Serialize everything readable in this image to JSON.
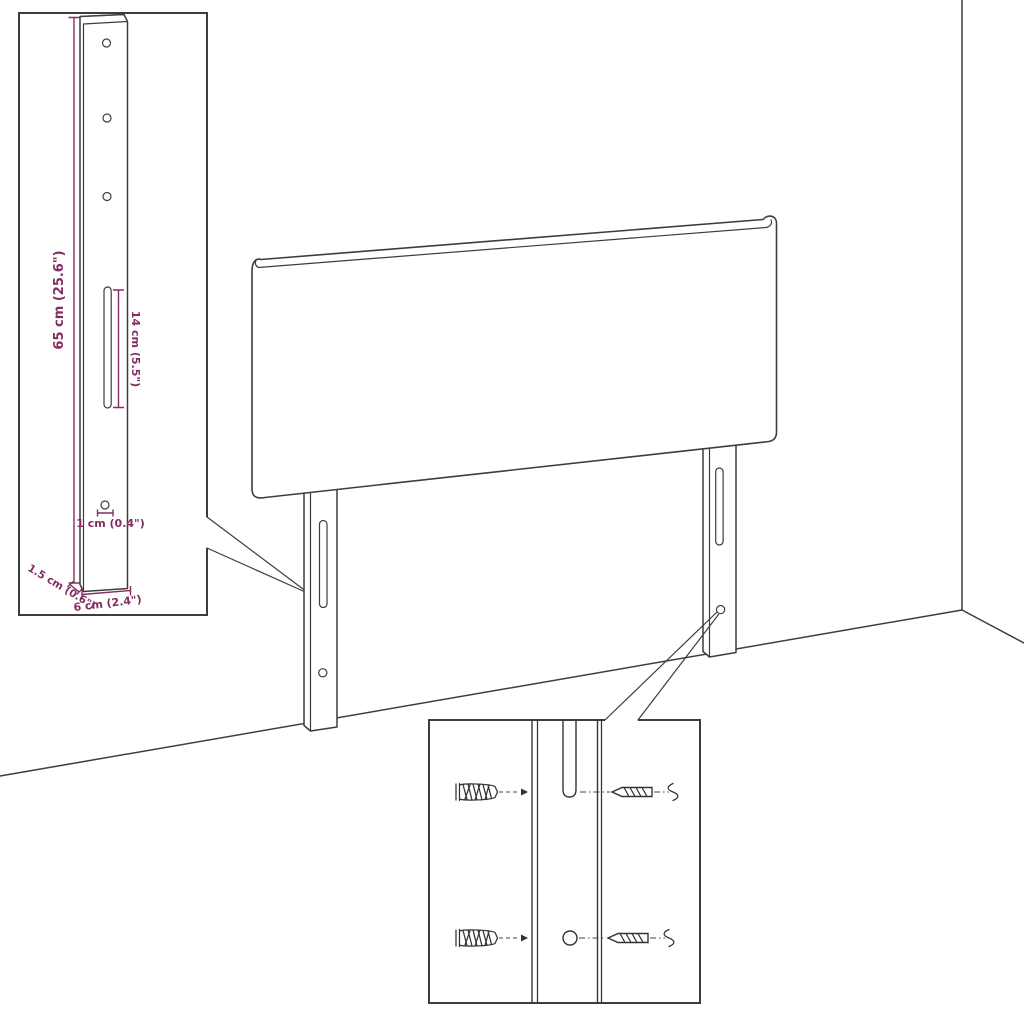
{
  "labels": {
    "bracket_height": "65 cm (25.6\")",
    "slot_length": "14 cm (5.5\")",
    "hole_diameter": "1 cm (0.4\")",
    "bracket_depth": "1.5 cm (0.6\")",
    "bracket_width": "6 cm (2.4\")"
  },
  "colors": {
    "dimension_text": "#822e63",
    "line_art": "#3d3d3d",
    "background": "#ffffff"
  }
}
